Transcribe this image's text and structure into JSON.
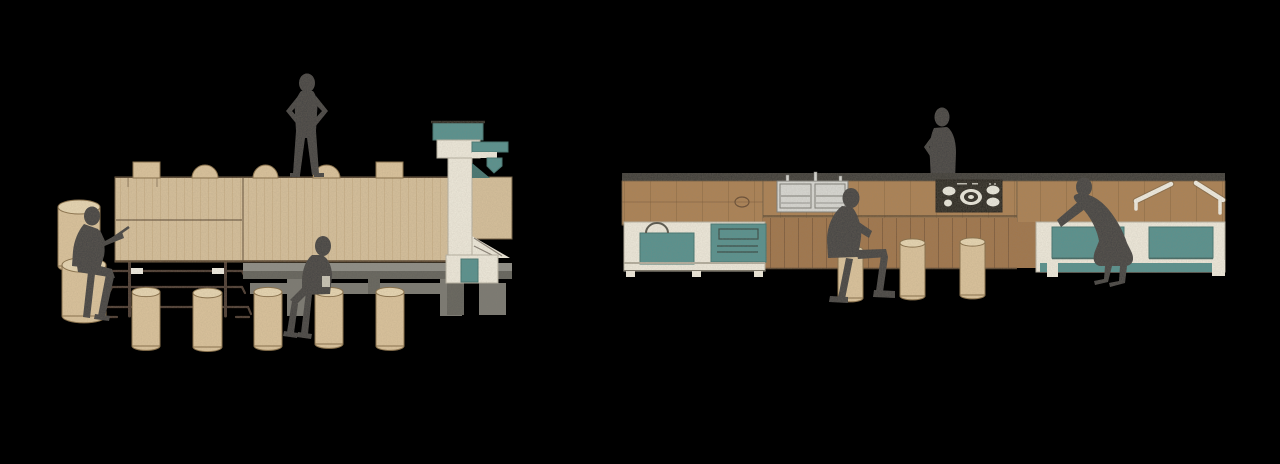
{
  "page": {
    "title": "Elevation rendering of communal table and kitchen counter units",
    "background": "#000000"
  },
  "scene": {
    "style": "watercolor sketch architectural elevation on black background",
    "units": [
      {
        "id": "communal-table",
        "side": "left",
        "description": "Long plywood communal table with steel trestle frame, grey bench base and integrated water column with teal tap",
        "stool_count": 7,
        "figure_count": 3,
        "tabletop_object_count": 5,
        "figures": [
          "person seated at left end reading",
          "person standing on tabletop, hands on hips",
          "person seated on stool in front"
        ]
      },
      {
        "id": "kitchen-counter",
        "side": "right",
        "description": "Plank-clad kitchen counter with double sink, five-burner cooktop, teal cabinet fronts and white stay braces",
        "stool_count": 3,
        "figure_count": 3,
        "appliances": [
          "double sink",
          "five-burner cooktop"
        ],
        "cabinet_front_count": 4,
        "figures": [
          "person seated at counter",
          "person standing behind counter",
          "person bending into cabinet"
        ]
      }
    ],
    "left_unit": {
      "tall_stools": [
        {
          "x": 58,
          "w": 42,
          "top": 207,
          "bottom": 268
        },
        {
          "x": 62,
          "w": 44,
          "top": 265,
          "bottom": 318
        }
      ],
      "stools": [
        {
          "x": 132,
          "w": 28,
          "top": 292,
          "bottom": 348
        },
        {
          "x": 193,
          "w": 29,
          "top": 293,
          "bottom": 349
        },
        {
          "x": 254,
          "w": 28,
          "top": 292,
          "bottom": 348
        },
        {
          "x": 315,
          "w": 28,
          "top": 292,
          "bottom": 346
        },
        {
          "x": 376,
          "w": 28,
          "top": 292,
          "bottom": 348
        }
      ],
      "tabletop_objects": [
        {
          "type": "block",
          "x": 133,
          "w": 27
        },
        {
          "type": "dome",
          "x": 192,
          "w": 26
        },
        {
          "type": "dome",
          "x": 253,
          "w": 25
        },
        {
          "type": "dome",
          "x": 313,
          "w": 27
        },
        {
          "type": "block",
          "x": 376,
          "w": 27
        }
      ]
    },
    "right_unit": {
      "stools": [
        {
          "x": 838,
          "w": 25,
          "top": 250,
          "bottom": 300
        },
        {
          "x": 900,
          "w": 25,
          "top": 243,
          "bottom": 298
        },
        {
          "x": 960,
          "w": 25,
          "top": 242,
          "bottom": 297
        }
      ]
    },
    "palette": {
      "background": "#000000",
      "wood_light": "#d7c19c",
      "wood_edge": "#6e5a3e",
      "apron_wood": "#ad8355",
      "panel_wood": "#a2774b",
      "plank_line": "#6b4c2d",
      "teal": "#559390",
      "teal_dark": "#3e7672",
      "cream": "#efeadc",
      "cream_shade": "#c9c5b6",
      "platform_gray": "#8f8f88",
      "platform_gray_dark": "#63635d",
      "bench_gray": "#7a7a73",
      "charcoal": "#3b3b38",
      "metal": "#47362a",
      "figure": "#434343",
      "cooktop": "#22201c",
      "burner": "#ebe9dd",
      "sink": "#d9d9d4",
      "sink_line": "#7f7f79",
      "stool": "#dcc49d",
      "stool_top": "#e8d7b3",
      "stool_edge": "#8a7149",
      "white_hw": "#f1ede1"
    }
  }
}
